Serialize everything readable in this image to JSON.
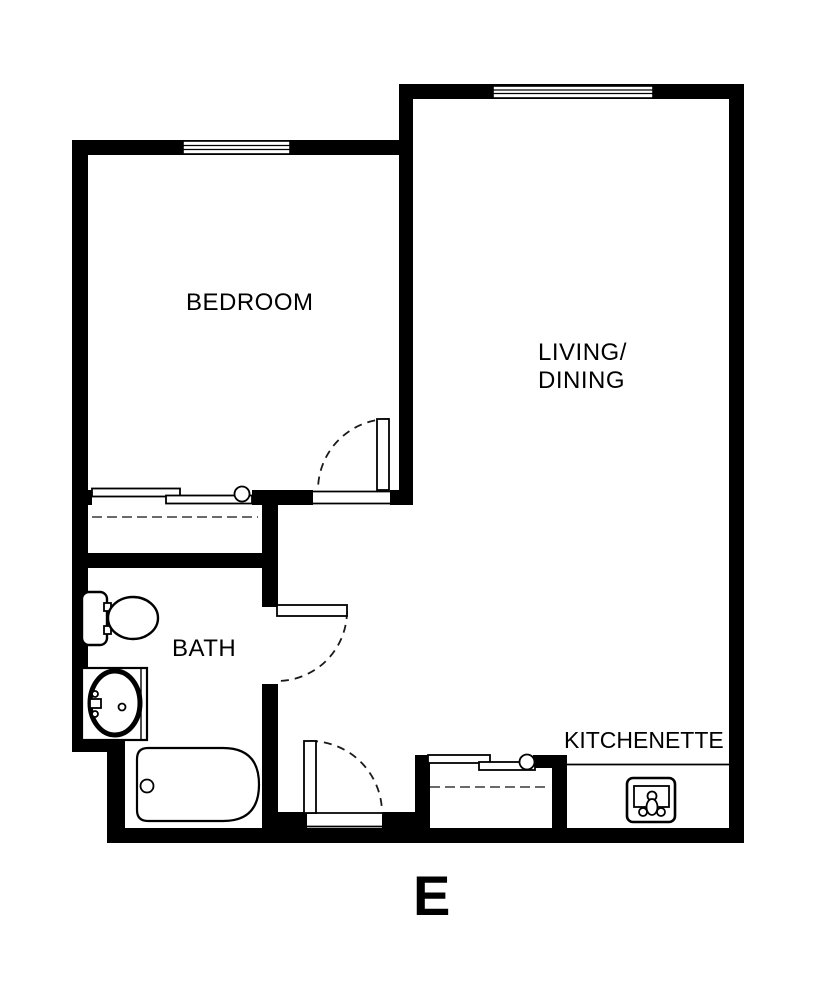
{
  "page": {
    "background": "#ffffff"
  },
  "floor_plan": {
    "type": "floor-plan",
    "unit": {
      "label": "E"
    },
    "rooms": {
      "bedroom": {
        "label": "BEDROOM"
      },
      "living_dining": {
        "line1": "LIVING/",
        "line2": "DINING"
      },
      "bath": {
        "label": "BATH"
      },
      "kitchenette": {
        "label": "KITCHENETTE"
      }
    },
    "fixtures": [
      "toilet",
      "vanity-sink",
      "bathtub",
      "kitchen-sink",
      "bedroom-closet-sliding-doors",
      "entry-closet-sliding-doors",
      "closet-rod-dashed-lines",
      "swing-door-bedroom",
      "swing-door-bath",
      "swing-door-entry",
      "window-bedroom",
      "window-living"
    ],
    "colors": {
      "wall": "#000000",
      "background": "#ffffff",
      "dashed_line": "#555555"
    }
  }
}
